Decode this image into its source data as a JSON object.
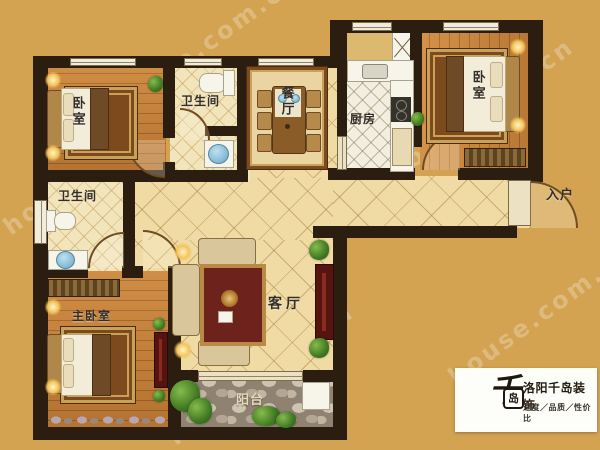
{
  "rooms": {
    "bedroom_top_left": {
      "label": "卧室"
    },
    "bathroom_top": {
      "label": "卫生间"
    },
    "dining": {
      "label": "餐厅"
    },
    "kitchen": {
      "label": "厨房"
    },
    "bedroom_top_right": {
      "label": "卧室"
    },
    "entry": {
      "label": "入户"
    },
    "bathroom_left": {
      "label": "卫生间"
    },
    "master_bedroom": {
      "label": "主卧室"
    },
    "living_room": {
      "label": "客厅"
    },
    "balcony": {
      "label": "阳台"
    }
  },
  "logo": {
    "mark_main": "千",
    "mark_boxed": "岛",
    "title": "洛阳千岛装饰",
    "subtitle": "速度／品质／性价比"
  },
  "watermark": {
    "text": "house.com.cn"
  },
  "colors": {
    "background": "#d3a351",
    "wall": "#2b1e11",
    "hall_tile": "#f0dba4",
    "bath_tile": "#f3e5bb",
    "wood": "#c8833c",
    "stone": "#8f8271",
    "accent_rug_red": "#6e221c",
    "logo_text": "#241c12"
  }
}
